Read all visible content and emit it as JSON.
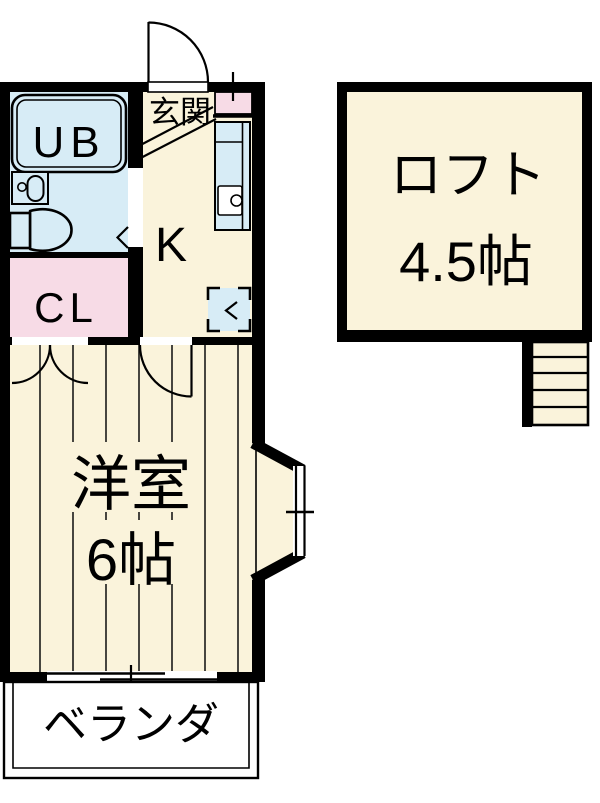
{
  "floorplan": {
    "rooms": {
      "entrance": {
        "label": "玄関"
      },
      "unit_bath": {
        "label": "UB"
      },
      "closet": {
        "label": "CL"
      },
      "kitchen": {
        "label": "K"
      },
      "western_room": {
        "label": "洋室",
        "size": "6帖"
      },
      "loft": {
        "label": "ロフト",
        "size": "4.5帖"
      },
      "veranda": {
        "label": "ベランダ"
      }
    },
    "colors": {
      "wall": "#000000",
      "floor": "#FAF3DB",
      "water": "#D7ECF6",
      "closet_pink": "#F7DBE6",
      "white": "#FFFFFF"
    }
  }
}
